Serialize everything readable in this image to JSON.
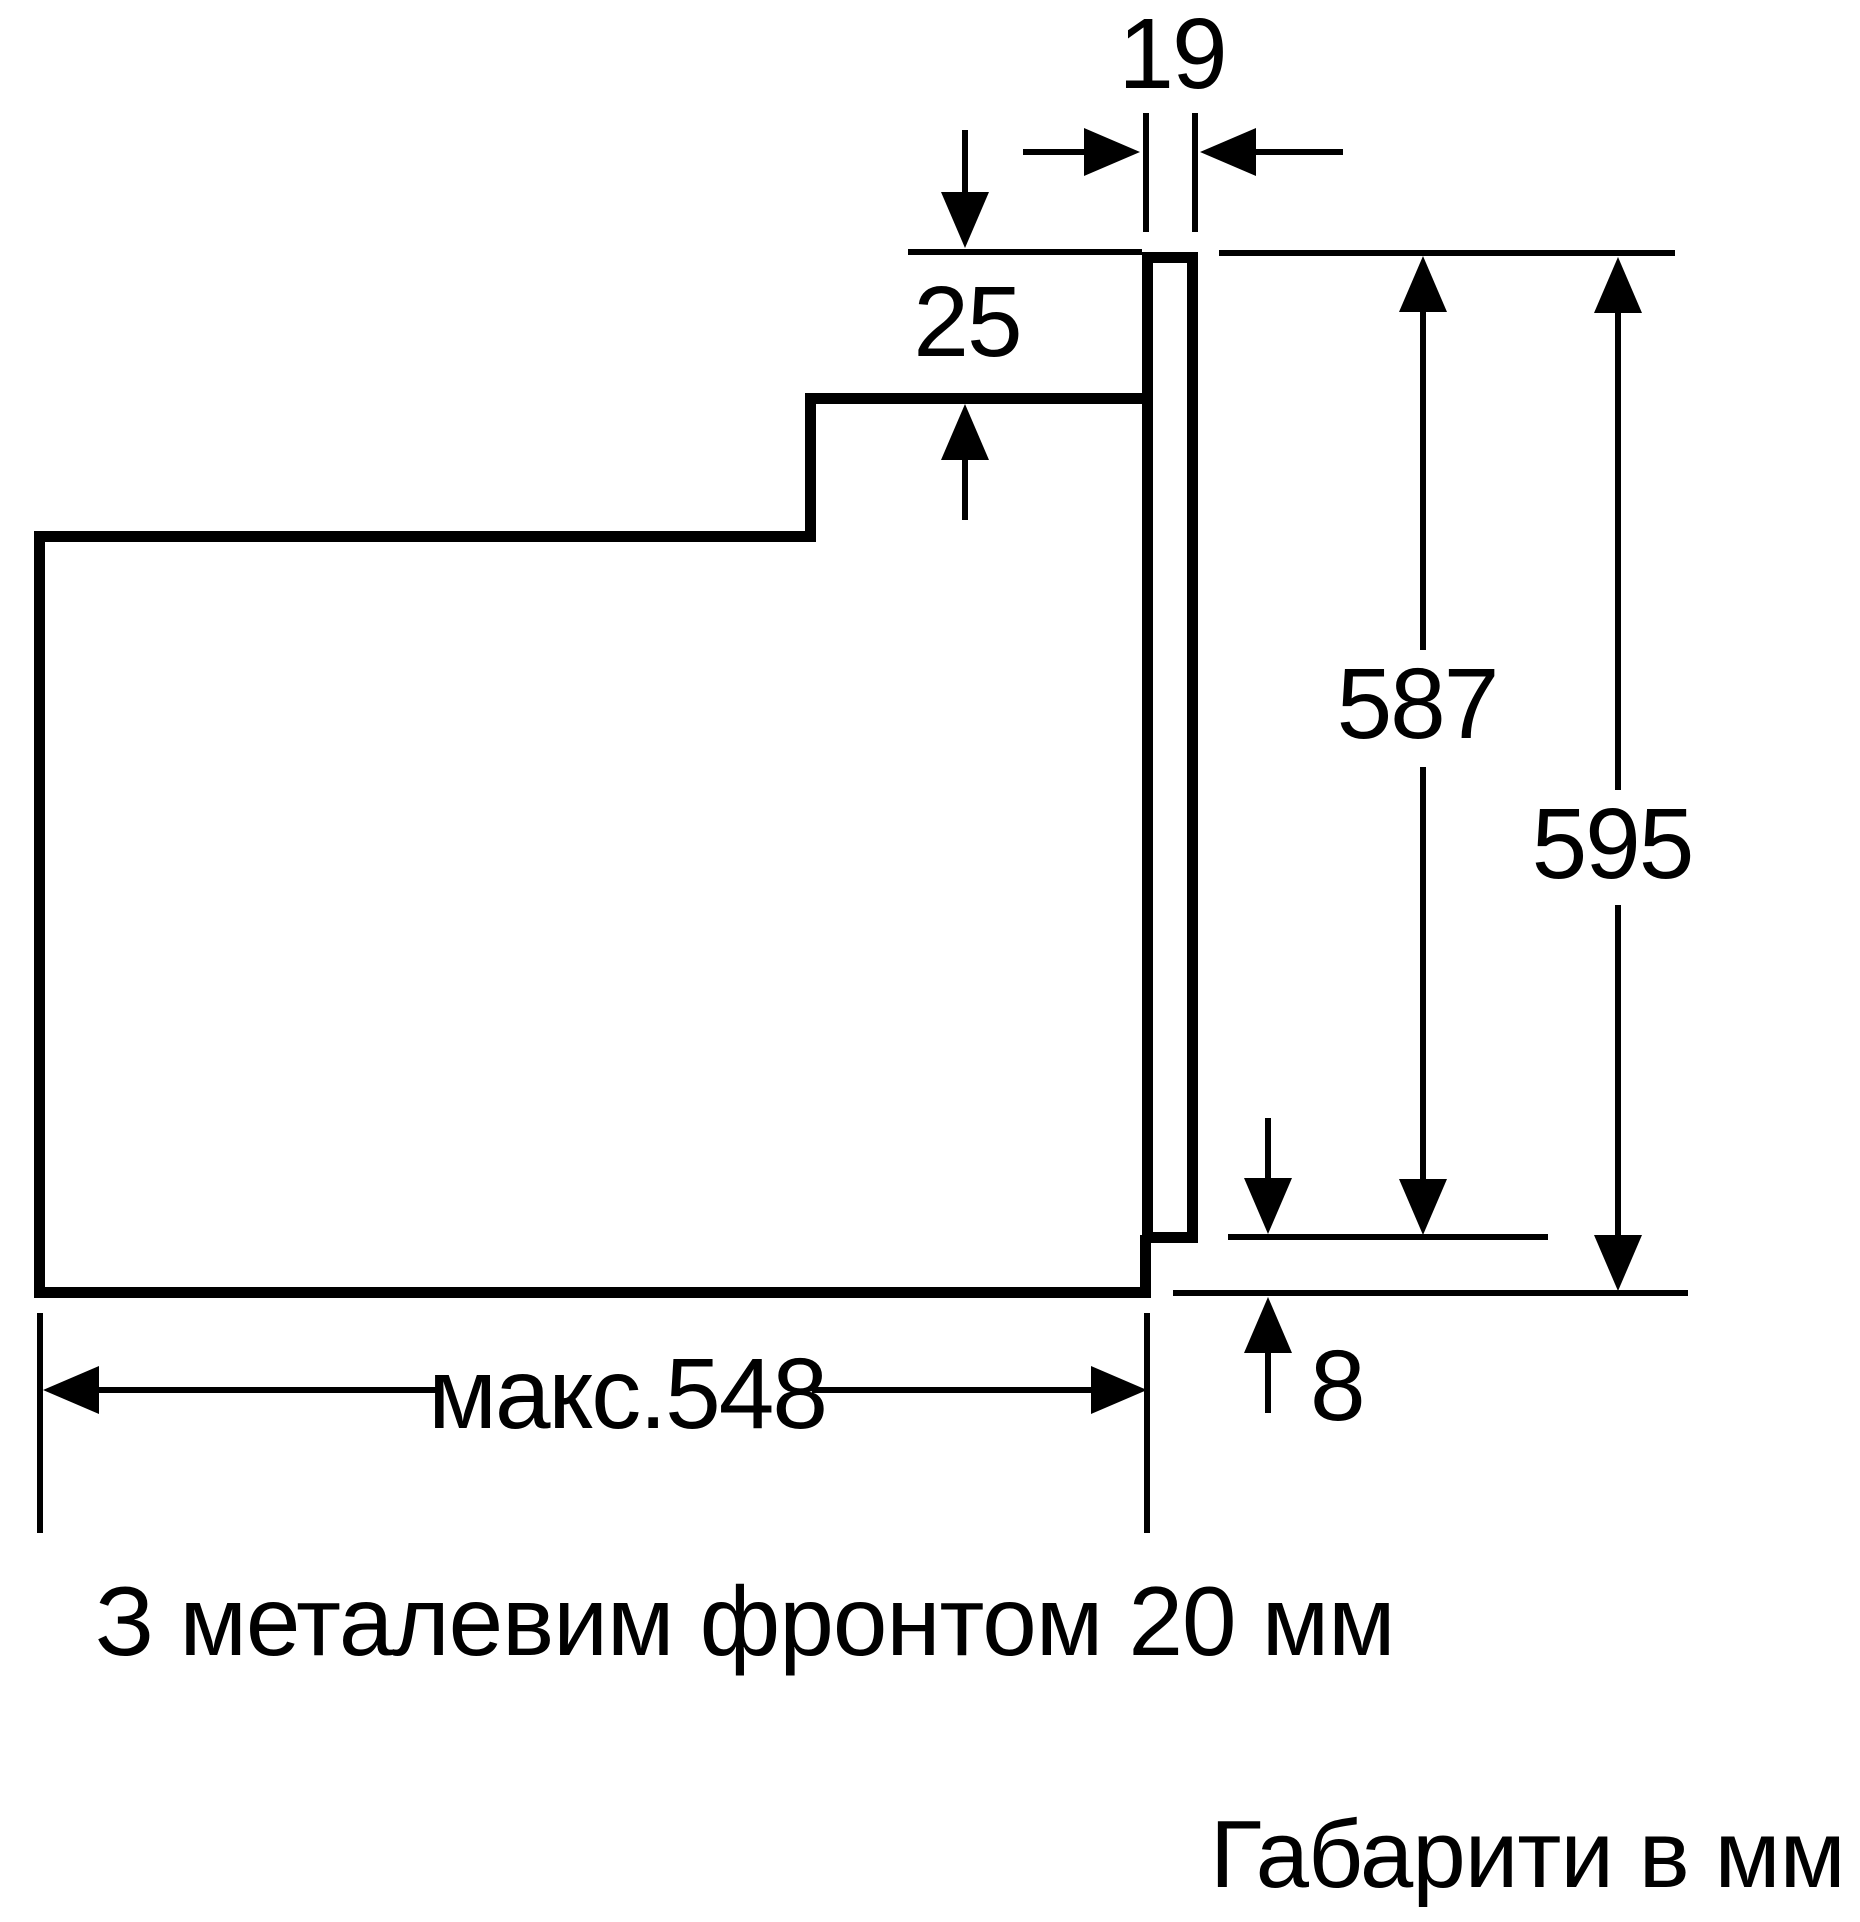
{
  "diagram": {
    "title_hidden": "",
    "dimensions": {
      "front_thickness": "19",
      "top_gap": "25",
      "niche_height": "587",
      "total_height": "595",
      "bottom_gap": "8",
      "max_depth": "макс.548"
    },
    "caption": "З металевим фронтом 20 мм",
    "footer": "Габарити в мм",
    "units": "мм",
    "colors": {
      "line": "#000000",
      "background": "#ffffff"
    }
  }
}
